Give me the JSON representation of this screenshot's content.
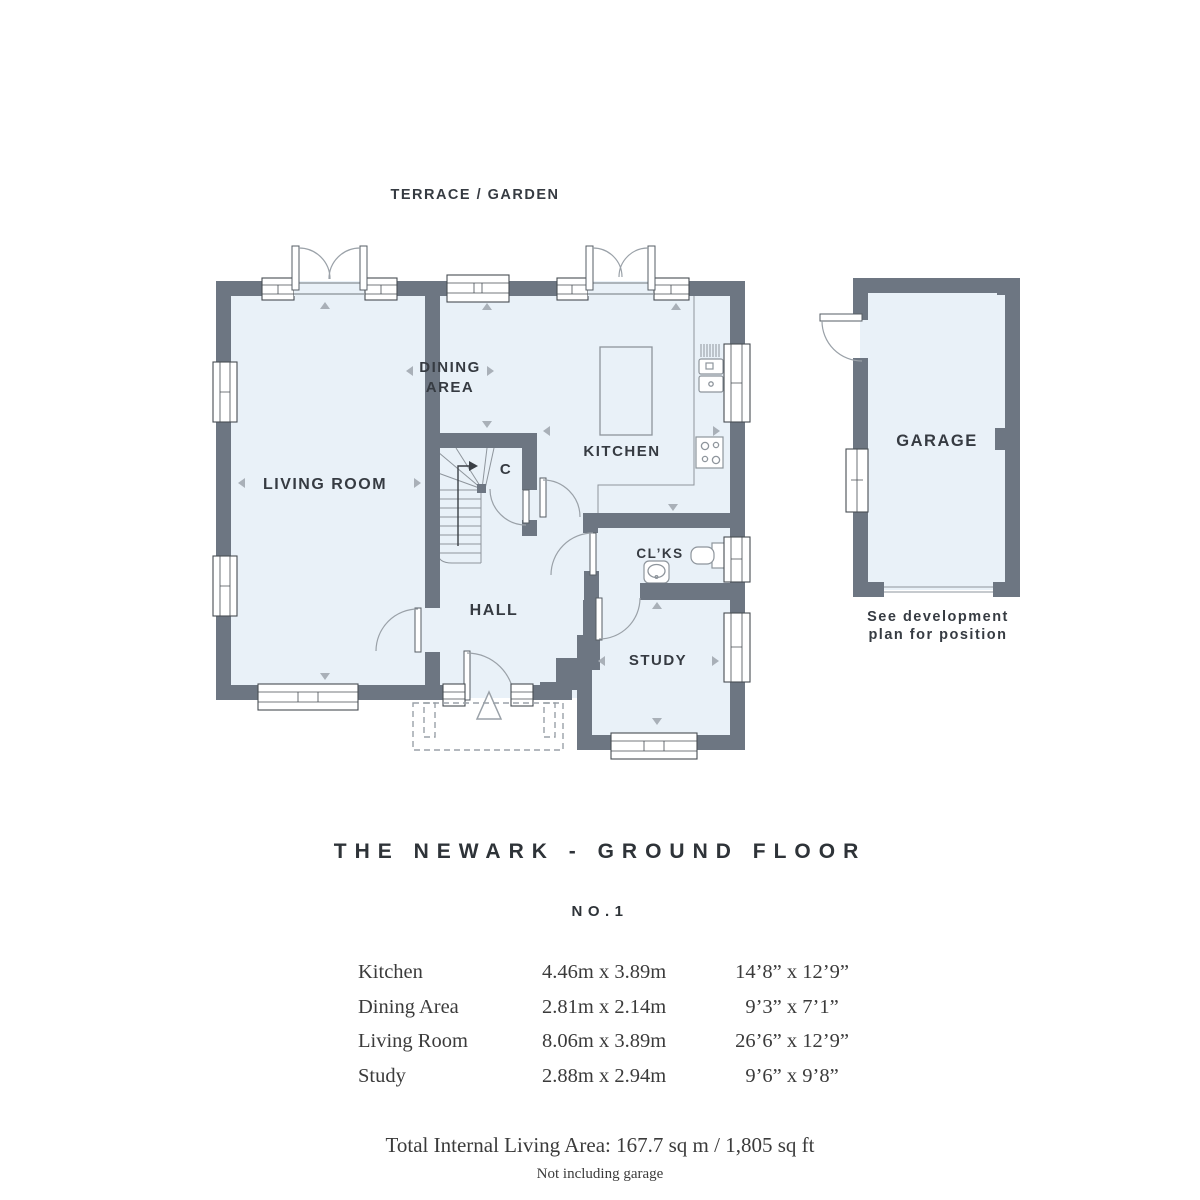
{
  "colors": {
    "wall": "#6d7682",
    "floor": "#e9f1f8",
    "fixture_line": "#8e959c",
    "arrow": "#a9b0b8",
    "text": "#363b42"
  },
  "plan": {
    "terrace_garden_label": "TERRACE / GARDEN",
    "rooms": {
      "living_room": "LIVING ROOM",
      "dining_line1": "DINING",
      "dining_line2": "AREA",
      "kitchen": "KITCHEN",
      "cupboard": "C",
      "hall": "HALL",
      "cloakroom": "CL’KS",
      "study": "STUDY",
      "garage": "GARAGE"
    },
    "garage_note": {
      "line1": "See development",
      "line2": "plan for position"
    }
  },
  "heading": {
    "title": "THE NEWARK - GROUND FLOOR",
    "plot_number": "NO.1"
  },
  "dimensions_table": {
    "rows": [
      {
        "room": "Kitchen",
        "metric": "4.46m x 3.89m",
        "imperial": "14’8” x 12’9”"
      },
      {
        "room": "Dining Area",
        "metric": "2.81m x 2.14m",
        "imperial": "9’3” x 7’1”"
      },
      {
        "room": "Living Room",
        "metric": "8.06m x 3.89m",
        "imperial": "26’6” x 12’9”"
      },
      {
        "room": "Study",
        "metric": "2.88m x 2.94m",
        "imperial": "9’6” x 9’8”"
      }
    ]
  },
  "summary": {
    "total_area": "Total Internal Living Area: 167.7 sq m / 1,805 sq ft",
    "note": "Not including garage"
  }
}
